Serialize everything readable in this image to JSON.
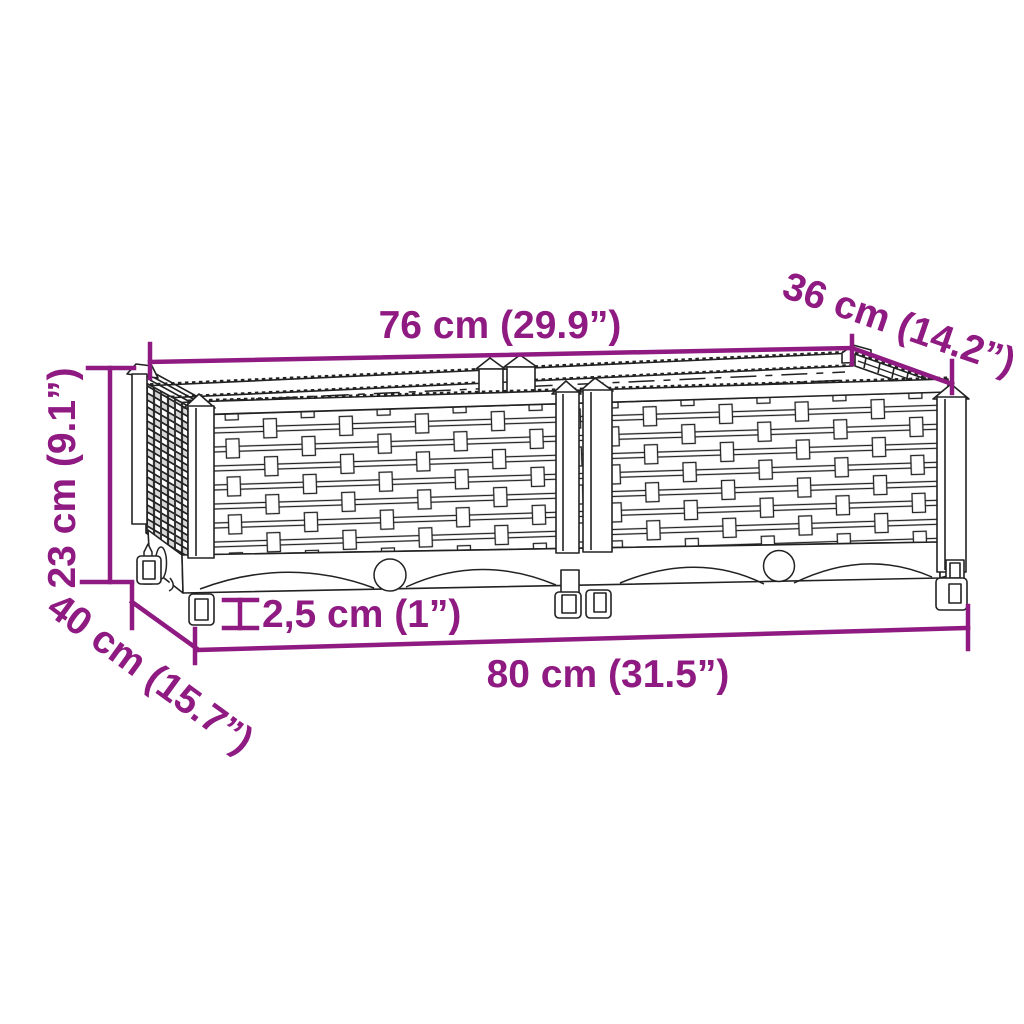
{
  "diagram": {
    "description": "Line drawing of a two-module rattan-look garden raised bed with dimension annotations",
    "accent_color": "#8E1A82",
    "line_color": "#222222",
    "background_color": "#FFFFFF",
    "labels": {
      "top_width": "76 cm (29.9”)",
      "top_depth": "36 cm (14.2”)",
      "height": "23 cm (9.1”)",
      "bottom_depth": "40 cm (15.7”)",
      "leg_height": "2,5 cm (1”)",
      "bottom_width": "80 cm (31.5”)"
    }
  }
}
